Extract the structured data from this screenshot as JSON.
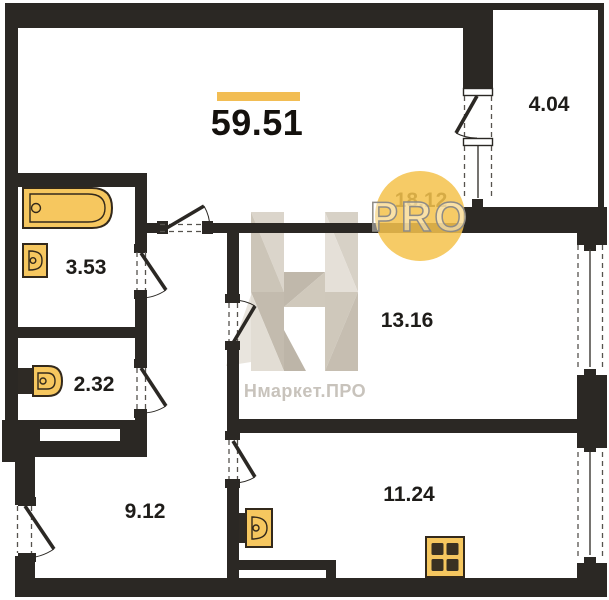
{
  "floorplan": {
    "total_area": "59.51",
    "badge": "PRO",
    "brand": "Нмаркет.ПРО",
    "logo_letter": "Н",
    "rooms": {
      "living_room": "18.12",
      "room": "13.16",
      "kitchen": "11.24",
      "hallway": "9.12",
      "bathroom": "3.53",
      "toilet": "2.32",
      "balcony": "4.04"
    },
    "icons": [
      "bathtub-icon",
      "sink-icon",
      "toilet-icon",
      "kitchen-sink-icon",
      "stove-icon"
    ],
    "colors": {
      "accent_bar": "#F2BD53",
      "walls": "#2B2824",
      "fixture_fill": "#F6C75F",
      "fixture_outline": "#33291B",
      "badge_fill": "#F5C34D",
      "watermark_text": "#C8C3BC",
      "background": "#FFFFFF"
    }
  }
}
